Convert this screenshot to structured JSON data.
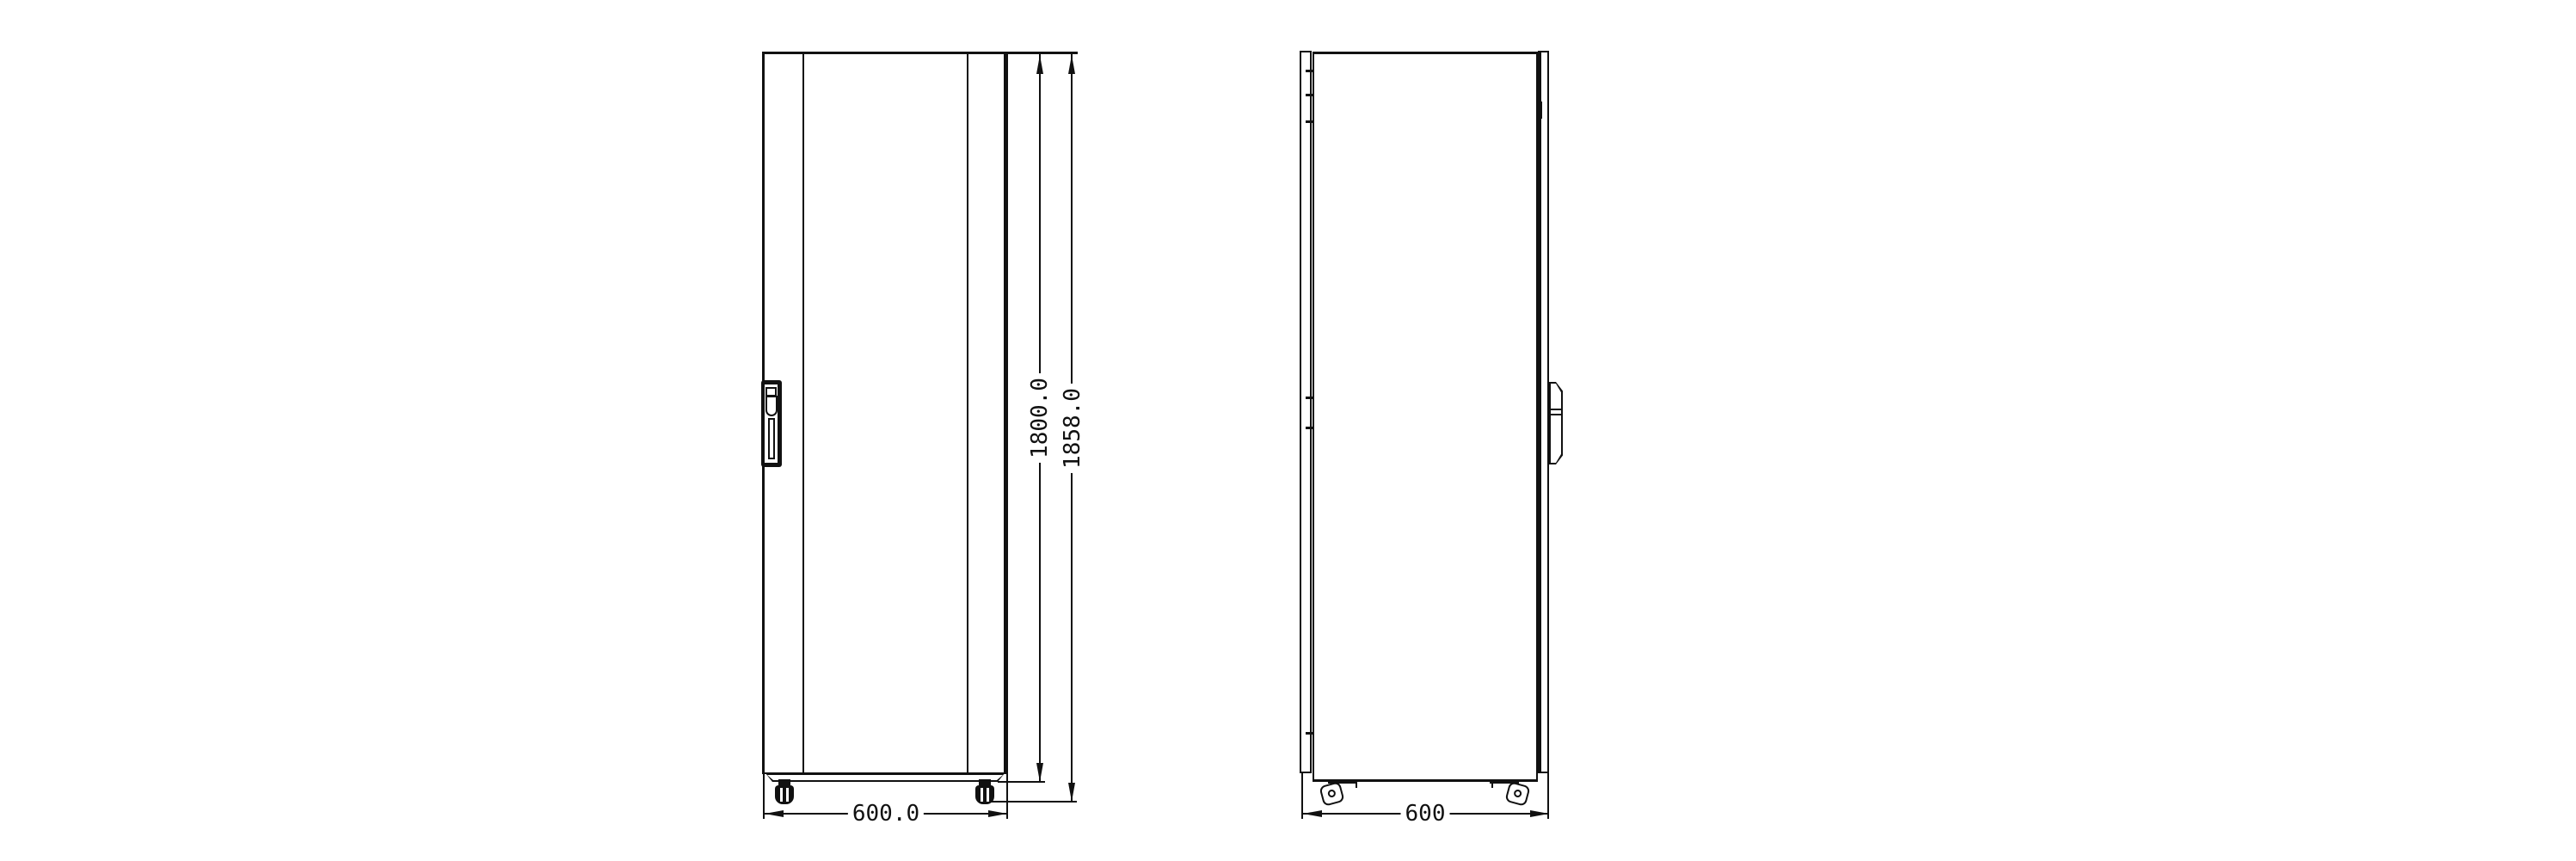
{
  "drawing": {
    "type": "technical-drawing",
    "subject": "rack cabinet, front and side orthographic views",
    "colors": {
      "line": "#111111",
      "background": "#ffffff"
    },
    "dimensions": {
      "front_width": "600.0",
      "front_height": "1800.0",
      "front_overall_height": "1858.0",
      "side_depth": "600"
    }
  }
}
